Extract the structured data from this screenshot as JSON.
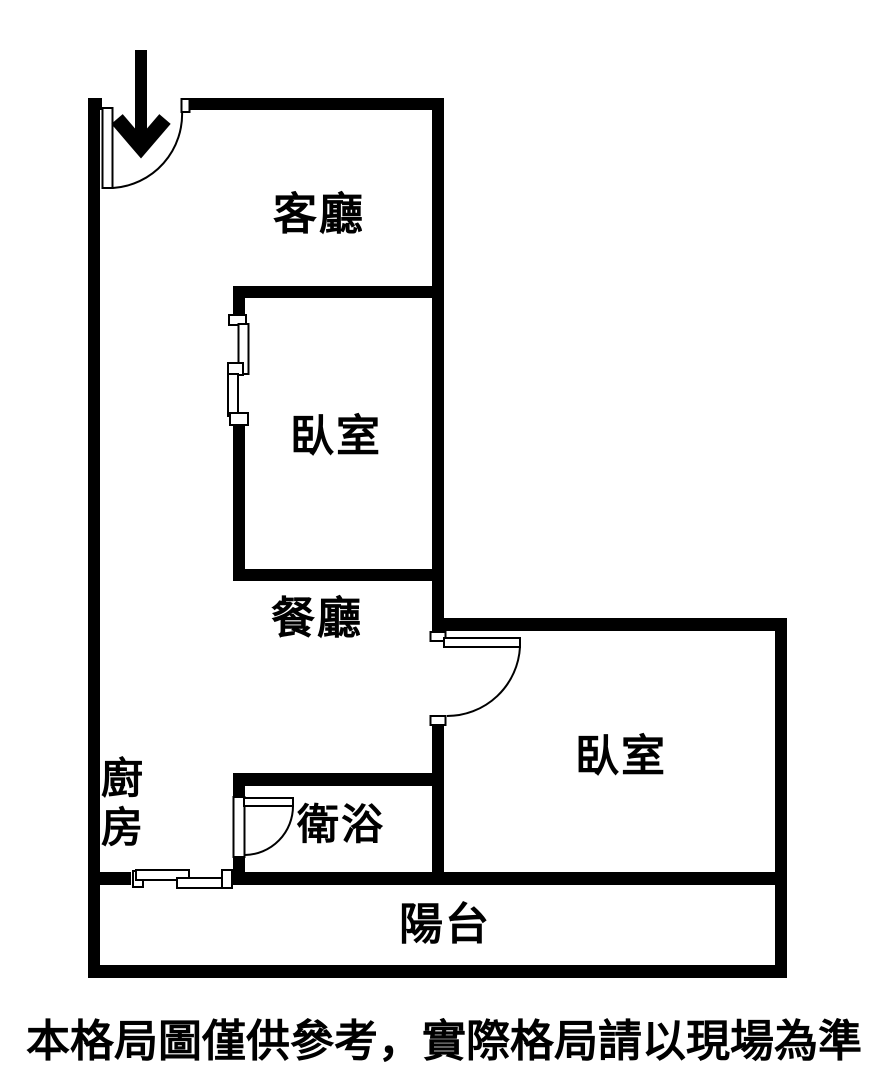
{
  "floor_plan": {
    "background_color": "#ffffff",
    "wall_color": "#000000",
    "text_color": "#000000",
    "entrance": {
      "icon": "arrow-down"
    },
    "rooms": {
      "living_room": {
        "label": "客廳"
      },
      "bedroom_main": {
        "label": "臥室"
      },
      "dining_room": {
        "label": "餐廳"
      },
      "kitchen": {
        "label": "廚房"
      },
      "bathroom": {
        "label": "衛浴"
      },
      "bedroom_second": {
        "label": "臥室"
      },
      "balcony": {
        "label": "陽台"
      }
    },
    "disclaimer": "本格局圖僅供參考，實際格局請以現場為準"
  }
}
